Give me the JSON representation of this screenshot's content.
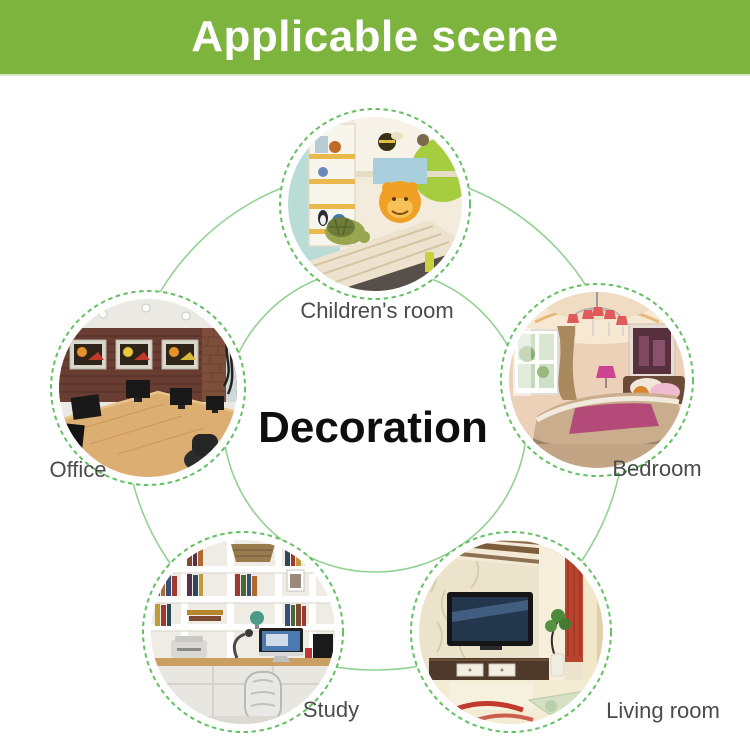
{
  "header": {
    "title": "Applicable scene"
  },
  "center": {
    "label": "Decoration"
  },
  "colors": {
    "header-bg": "#7cb43e",
    "header-text": "#ffffff",
    "line-green": "#93d193",
    "dash-green": "#64c064",
    "label-gray": "#4b4b4b",
    "center-text": "#0e0e0e",
    "page-bg": "#ffffff"
  },
  "scenes": [
    {
      "id": "childrens-room",
      "label": "Children's room"
    },
    {
      "id": "office",
      "label": "Office"
    },
    {
      "id": "bedroom",
      "label": "Bedroom"
    },
    {
      "id": "study",
      "label": "Study"
    },
    {
      "id": "living-room",
      "label": "Living room"
    }
  ]
}
